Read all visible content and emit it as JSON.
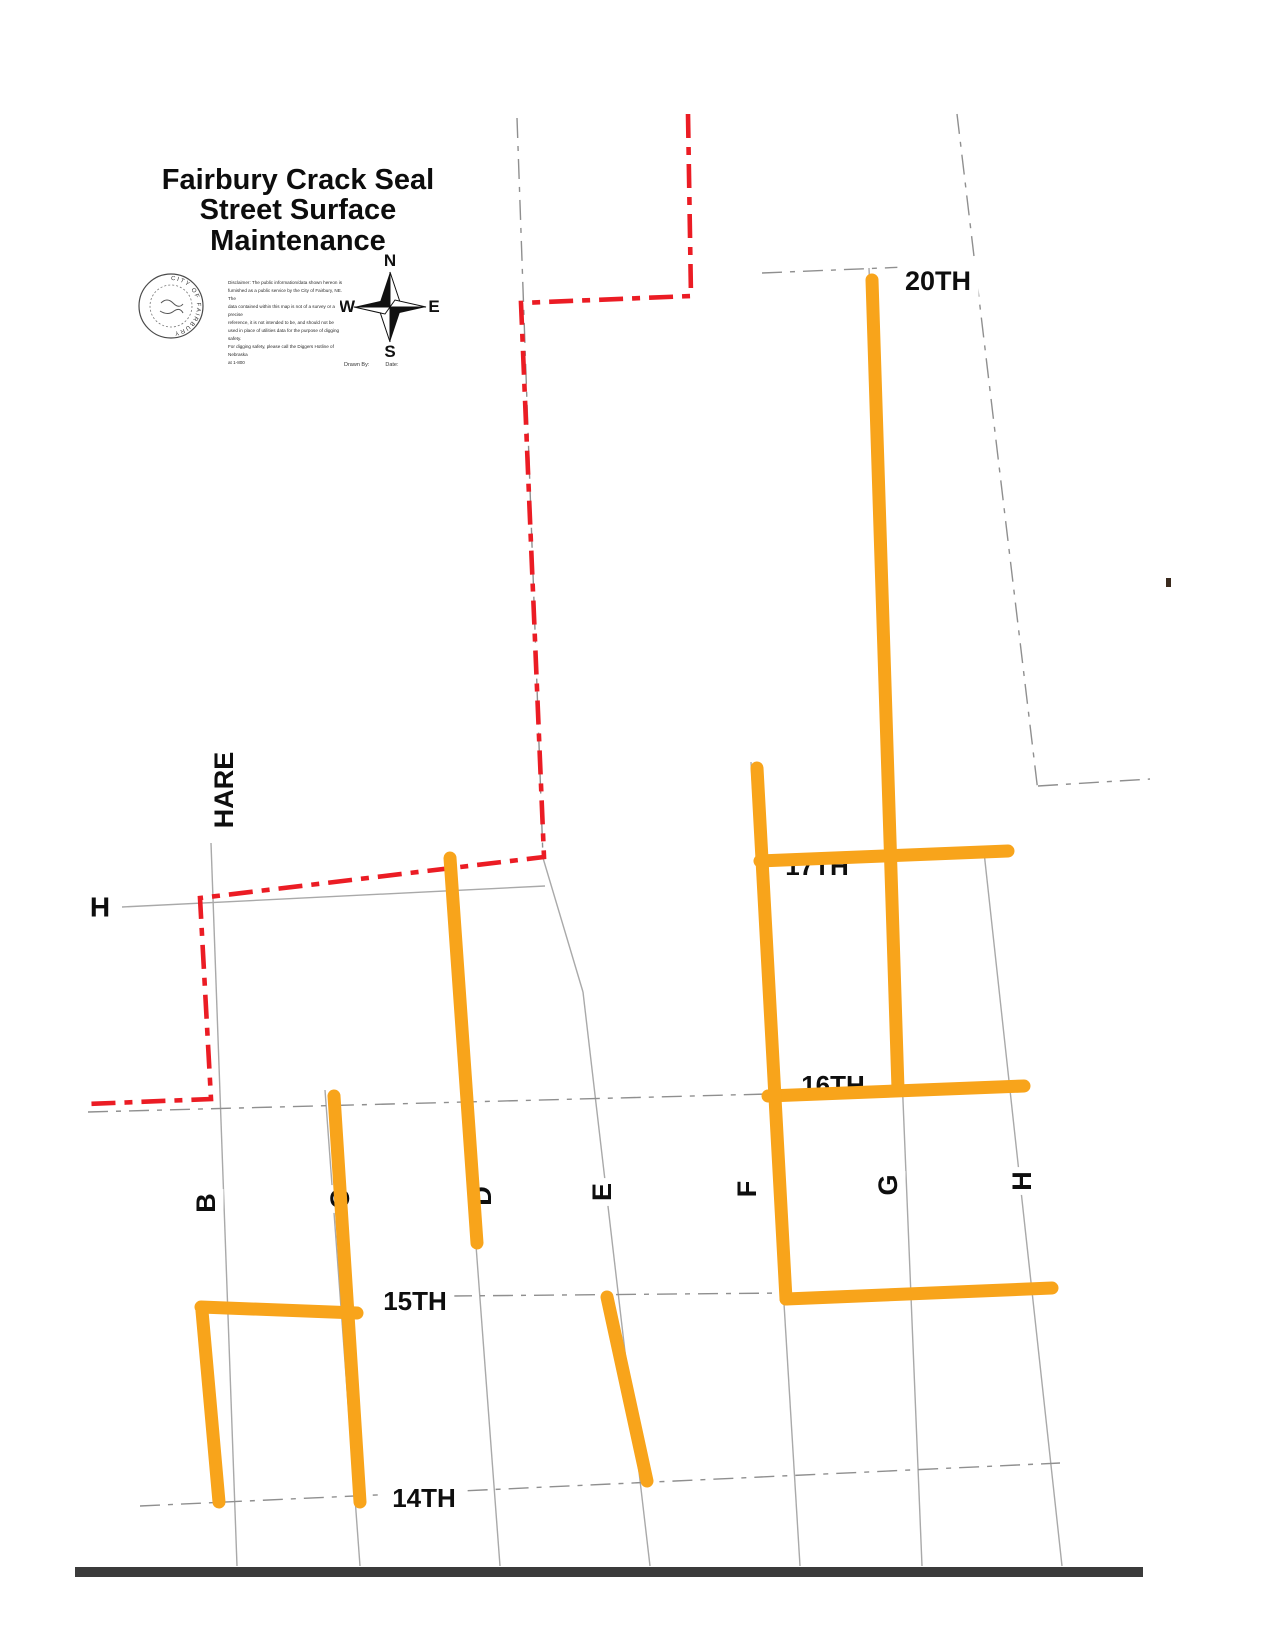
{
  "title": {
    "line1": "Fairbury Crack Seal",
    "line2": "Street Surface Maintenance"
  },
  "legend": {
    "seal_text": "CITY OF FAIRBURY",
    "disclaimer_lines": [
      "Disclaimer: The public information/data shown hereon is",
      "furnished as a public service by the City of Fairbury, NE. The",
      "data contained within this map is not of a survey or a precise",
      "reference, it is not intended to be, and should not be",
      "used in place of utilities data for the purpose of digging safety.",
      "For digging safety, please call the Diggers Hotline of Nebraska",
      "at 1-800"
    ],
    "drawn_by_label": "Drawn By:",
    "date_label": "Date:"
  },
  "compass": {
    "north": "N",
    "south": "S",
    "east": "E",
    "west": "W"
  },
  "colors": {
    "crack_seal": "#F8A41B",
    "boundary": "#EB1C24",
    "street": "#A9A9A9",
    "street_dark": "#8F8F8F",
    "label": "#0E0E0E",
    "bar": "#3B3B3B"
  },
  "map": {
    "street_labels": [
      {
        "id": "20th",
        "text": "20TH",
        "x": 938,
        "y": 281,
        "size": 27,
        "rotate": 0,
        "bg": true,
        "layer": "over"
      },
      {
        "id": "17th",
        "text": "17TH",
        "x": 817,
        "y": 866,
        "size": 26,
        "rotate": 0,
        "bg": false,
        "layer": "under"
      },
      {
        "id": "16th",
        "text": "16TH",
        "x": 833,
        "y": 1085,
        "size": 26,
        "rotate": 0,
        "bg": false,
        "layer": "under"
      },
      {
        "id": "15th",
        "text": "15TH",
        "x": 415,
        "y": 1301,
        "size": 26,
        "rotate": 0,
        "bg": true,
        "layer": "over"
      },
      {
        "id": "14th",
        "text": "14TH",
        "x": 424,
        "y": 1498,
        "size": 26,
        "rotate": 0,
        "bg": true,
        "layer": "over"
      },
      {
        "id": "h-west",
        "text": "H",
        "x": 100,
        "y": 907,
        "size": 28,
        "rotate": 0,
        "bg": true,
        "layer": "over"
      },
      {
        "id": "hare",
        "text": "HARE",
        "x": 224,
        "y": 790,
        "size": 27,
        "rotate": -90,
        "bg": true,
        "layer": "over"
      },
      {
        "id": "b",
        "text": "B",
        "x": 206,
        "y": 1203,
        "size": 27,
        "rotate": -90,
        "bg": true,
        "layer": "over"
      },
      {
        "id": "c",
        "text": "C",
        "x": 340,
        "y": 1199,
        "size": 27,
        "rotate": -90,
        "bg": true,
        "layer": "under"
      },
      {
        "id": "d",
        "text": "D",
        "x": 482,
        "y": 1196,
        "size": 27,
        "rotate": -90,
        "bg": true,
        "layer": "under"
      },
      {
        "id": "e",
        "text": "E",
        "x": 602,
        "y": 1192,
        "size": 27,
        "rotate": -90,
        "bg": true,
        "layer": "over"
      },
      {
        "id": "f",
        "text": "F",
        "x": 747,
        "y": 1189,
        "size": 27,
        "rotate": -90,
        "bg": true,
        "layer": "under"
      },
      {
        "id": "g",
        "text": "G",
        "x": 888,
        "y": 1185,
        "size": 27,
        "rotate": -90,
        "bg": true,
        "layer": "over"
      },
      {
        "id": "h-east",
        "text": "H",
        "x": 1022,
        "y": 1181,
        "size": 27,
        "rotate": -90,
        "bg": true,
        "layer": "over"
      }
    ],
    "gray_lines": [
      {
        "id": "b-column",
        "x1": 211,
        "y1": 843,
        "x2": 237,
        "y2": 1566,
        "dashed": false
      },
      {
        "id": "c-column",
        "x1": 325,
        "y1": 1090,
        "x2": 360,
        "y2": 1566,
        "dashed": false
      },
      {
        "id": "d-column",
        "x1": 447,
        "y1": 858,
        "x2": 500,
        "y2": 1566,
        "dashed": false
      },
      {
        "id": "e-column-north",
        "x1": 517,
        "y1": 118,
        "x2": 543,
        "y2": 858,
        "dashed": true
      },
      {
        "id": "e-column-bend",
        "x1": 543,
        "y1": 858,
        "x2": 583,
        "y2": 992,
        "dashed": false
      },
      {
        "id": "e-column-south",
        "x1": 583,
        "y1": 992,
        "x2": 650,
        "y2": 1566,
        "dashed": false
      },
      {
        "id": "f-column",
        "x1": 751,
        "y1": 762,
        "x2": 800,
        "y2": 1566,
        "dashed": false
      },
      {
        "id": "g-column",
        "x1": 869,
        "y1": 268,
        "x2": 922,
        "y2": 1566,
        "dashed": false
      },
      {
        "id": "northeast-column",
        "x1": 957,
        "y1": 114,
        "x2": 1038,
        "y2": 792,
        "dashed": true
      },
      {
        "id": "h-column",
        "x1": 984,
        "y1": 852,
        "x2": 1062,
        "y2": 1566,
        "dashed": false
      },
      {
        "id": "20th-row",
        "x1": 762,
        "y1": 273,
        "x2": 955,
        "y2": 265,
        "dashed": true
      },
      {
        "id": "east-spur-row",
        "x1": 1038,
        "y1": 786,
        "x2": 1150,
        "y2": 779,
        "dashed": true
      },
      {
        "id": "h-street-row",
        "x1": 122,
        "y1": 907,
        "x2": 545,
        "y2": 886,
        "dashed": false
      },
      {
        "id": "16th-row-west",
        "x1": 88,
        "y1": 1112,
        "x2": 768,
        "y2": 1094,
        "dashed": true
      },
      {
        "id": "15th-row",
        "x1": 452,
        "y1": 1296,
        "x2": 786,
        "y2": 1293,
        "dashed": true
      },
      {
        "id": "14th-row",
        "x1": 140,
        "y1": 1506,
        "x2": 1060,
        "y2": 1463,
        "dashed": true
      }
    ],
    "boundary_path": [
      [
        688,
        114
      ],
      [
        691,
        296
      ],
      [
        521,
        303
      ],
      [
        544,
        857
      ],
      [
        200,
        898
      ],
      [
        211,
        1099
      ],
      [
        88,
        1104
      ]
    ],
    "crack_seal_segments": [
      {
        "id": "g-street-20th-to-16th",
        "x1": 872,
        "y1": 280,
        "x2": 898,
        "y2": 1089
      },
      {
        "id": "17th-street-f-to-h",
        "x1": 760,
        "y1": 861,
        "x2": 1008,
        "y2": 851
      },
      {
        "id": "16th-street-f-to-h",
        "x1": 768,
        "y1": 1096,
        "x2": 1024,
        "y2": 1086
      },
      {
        "id": "15th-street-f-to-h",
        "x1": 786,
        "y1": 1299,
        "x2": 1052,
        "y2": 1288
      },
      {
        "id": "f-street-17th-to-15th",
        "x1": 757,
        "y1": 768,
        "x2": 786,
        "y2": 1299
      },
      {
        "id": "d-street-h-to-15th",
        "x1": 450,
        "y1": 858,
        "x2": 477,
        "y2": 1243
      },
      {
        "id": "c-street-16th-to-14th",
        "x1": 334,
        "y1": 1096,
        "x2": 360,
        "y2": 1502
      },
      {
        "id": "b-street-15th-to-14th",
        "x1": 202,
        "y1": 1311,
        "x2": 219,
        "y2": 1502
      },
      {
        "id": "15th-street-b-to-c",
        "x1": 201,
        "y1": 1307,
        "x2": 357,
        "y2": 1313
      },
      {
        "id": "e-street-15th-to-14th",
        "x1": 607,
        "y1": 1297,
        "x2": 647,
        "y2": 1481
      }
    ],
    "bottom_bar": {
      "x": 75,
      "y": 1567,
      "w": 1068,
      "h": 10
    },
    "stray_mark": {
      "x": 1166,
      "y": 578,
      "w": 5,
      "h": 9
    }
  }
}
